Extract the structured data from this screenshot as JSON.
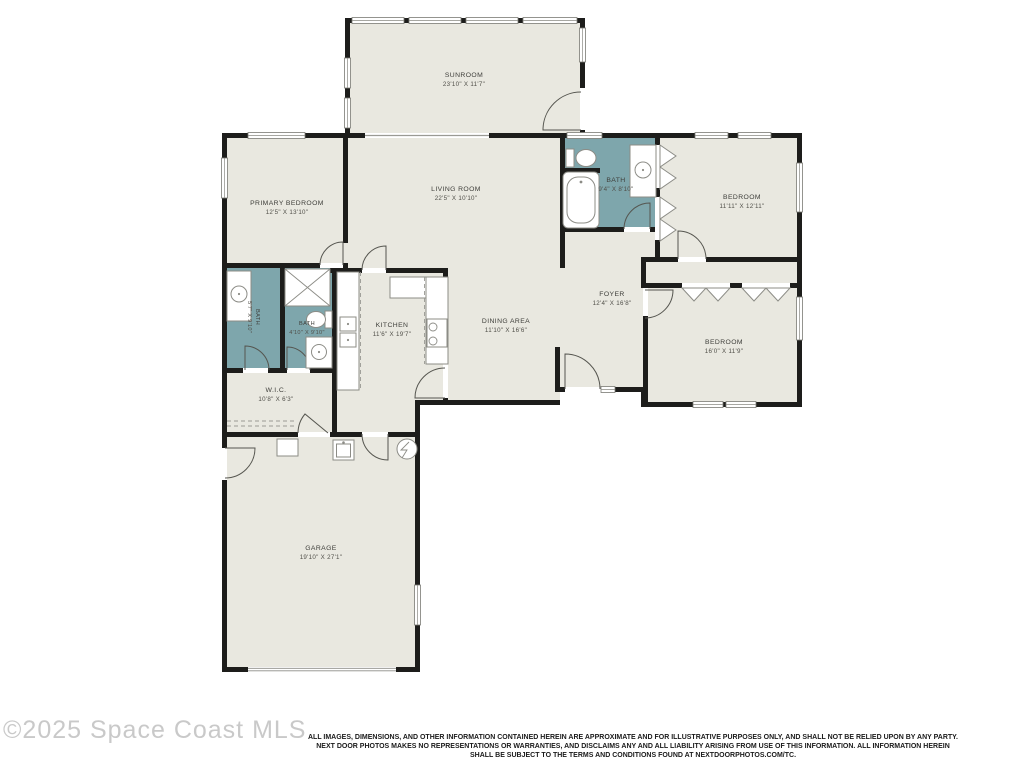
{
  "watermark": "©2025 Space Coast MLS",
  "disclaimer": {
    "line1": "ALL IMAGES, DIMENSIONS, AND OTHER INFORMATION CONTAINED HEREIN ARE APPROXIMATE AND FOR ILLUSTRATIVE PURPOSES ONLY, AND SHALL NOT BE RELIED UPON BY ANY PARTY.",
    "line2": "NEXT DOOR PHOTOS MAKES NO REPRESENTATIONS OR WARRANTIES, AND DISCLAIMS ANY AND ALL LIABILITY ARISING FROM USE OF THIS INFORMATION. ALL INFORMATION HEREIN",
    "line3": "SHALL BE SUBJECT TO THE TERMS AND CONDITIONS FOUND AT NEXTDOORPHOTOS.COM/TC."
  },
  "colors": {
    "floor": "#e9e8e0",
    "bath": "#7ea6ac",
    "wall": "#1d1d1b",
    "watermark_gray": "#c9c9c9"
  },
  "rooms": {
    "sunroom": {
      "name": "SUNROOM",
      "dims": "23'10\" X 11'7\""
    },
    "living_room": {
      "name": "LIVING ROOM",
      "dims": "22'5\" X 10'10\""
    },
    "primary_bedroom": {
      "name": "PRIMARY BEDROOM",
      "dims": "12'5\" X 13'10\""
    },
    "bath_main": {
      "name": "BATH",
      "dims": "9'4\" X 8'10\""
    },
    "bedroom_ne": {
      "name": "BEDROOM",
      "dims": "11'11\" X 12'11\""
    },
    "foyer": {
      "name": "FOYER",
      "dims": "12'4\" X 16'8\""
    },
    "bedroom_se": {
      "name": "BEDROOM",
      "dims": "16'0\" X 11'9\""
    },
    "kitchen": {
      "name": "KITCHEN",
      "dims": "11'6\" X 19'7\""
    },
    "dining_area": {
      "name": "DINING AREA",
      "dims": "11'10\" X 16'6\""
    },
    "bath_hall": {
      "name": "BATH",
      "dims": "5'7\" X 9'10\""
    },
    "bath_small": {
      "name": "BATH",
      "dims": "4'10\" X 9'10\""
    },
    "wic": {
      "name": "W.I.C.",
      "dims": "10'8\" X 6'3\""
    },
    "garage": {
      "name": "GARAGE",
      "dims": "19'10\" X 27'1\""
    }
  }
}
